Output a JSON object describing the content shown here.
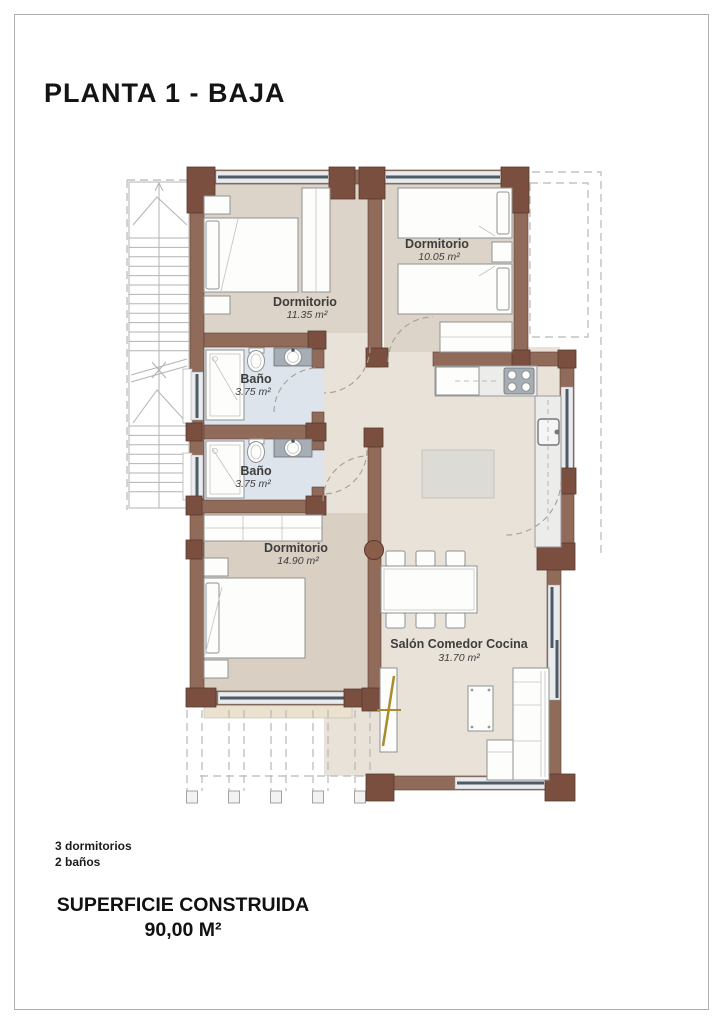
{
  "page": {
    "title": "PLANTA 1 - BAJA"
  },
  "plan": {
    "rooms": [
      {
        "name": "Dormitorio",
        "area": "11.35 m²"
      },
      {
        "name": "Dormitorio",
        "area": "10.05 m²"
      },
      {
        "name": "Baño",
        "area": "3.75 m²"
      },
      {
        "name": "Baño",
        "area": "3.75 m²"
      },
      {
        "name": "Dormitorio",
        "area": "14.90 m²"
      },
      {
        "name": "Salón Comedor Cocina",
        "area": "31.70 m²"
      }
    ],
    "colors": {
      "wall": "#906b59",
      "pillar": "#7b4f40",
      "bedroom_floor": "#dcd4c8",
      "living_floor": "#e8e2d8",
      "bath_floor": "#dee4ec",
      "terrace": "#eae2cf",
      "window_line": "#4e5a66",
      "gold_handle": "#ab8c2d"
    }
  },
  "summary": {
    "bedrooms": "3 dormitorios",
    "bathrooms": "2 baños",
    "built_area_label": "SUPERFICIE CONSTRUIDA",
    "built_area_value": "90,00 M²"
  }
}
